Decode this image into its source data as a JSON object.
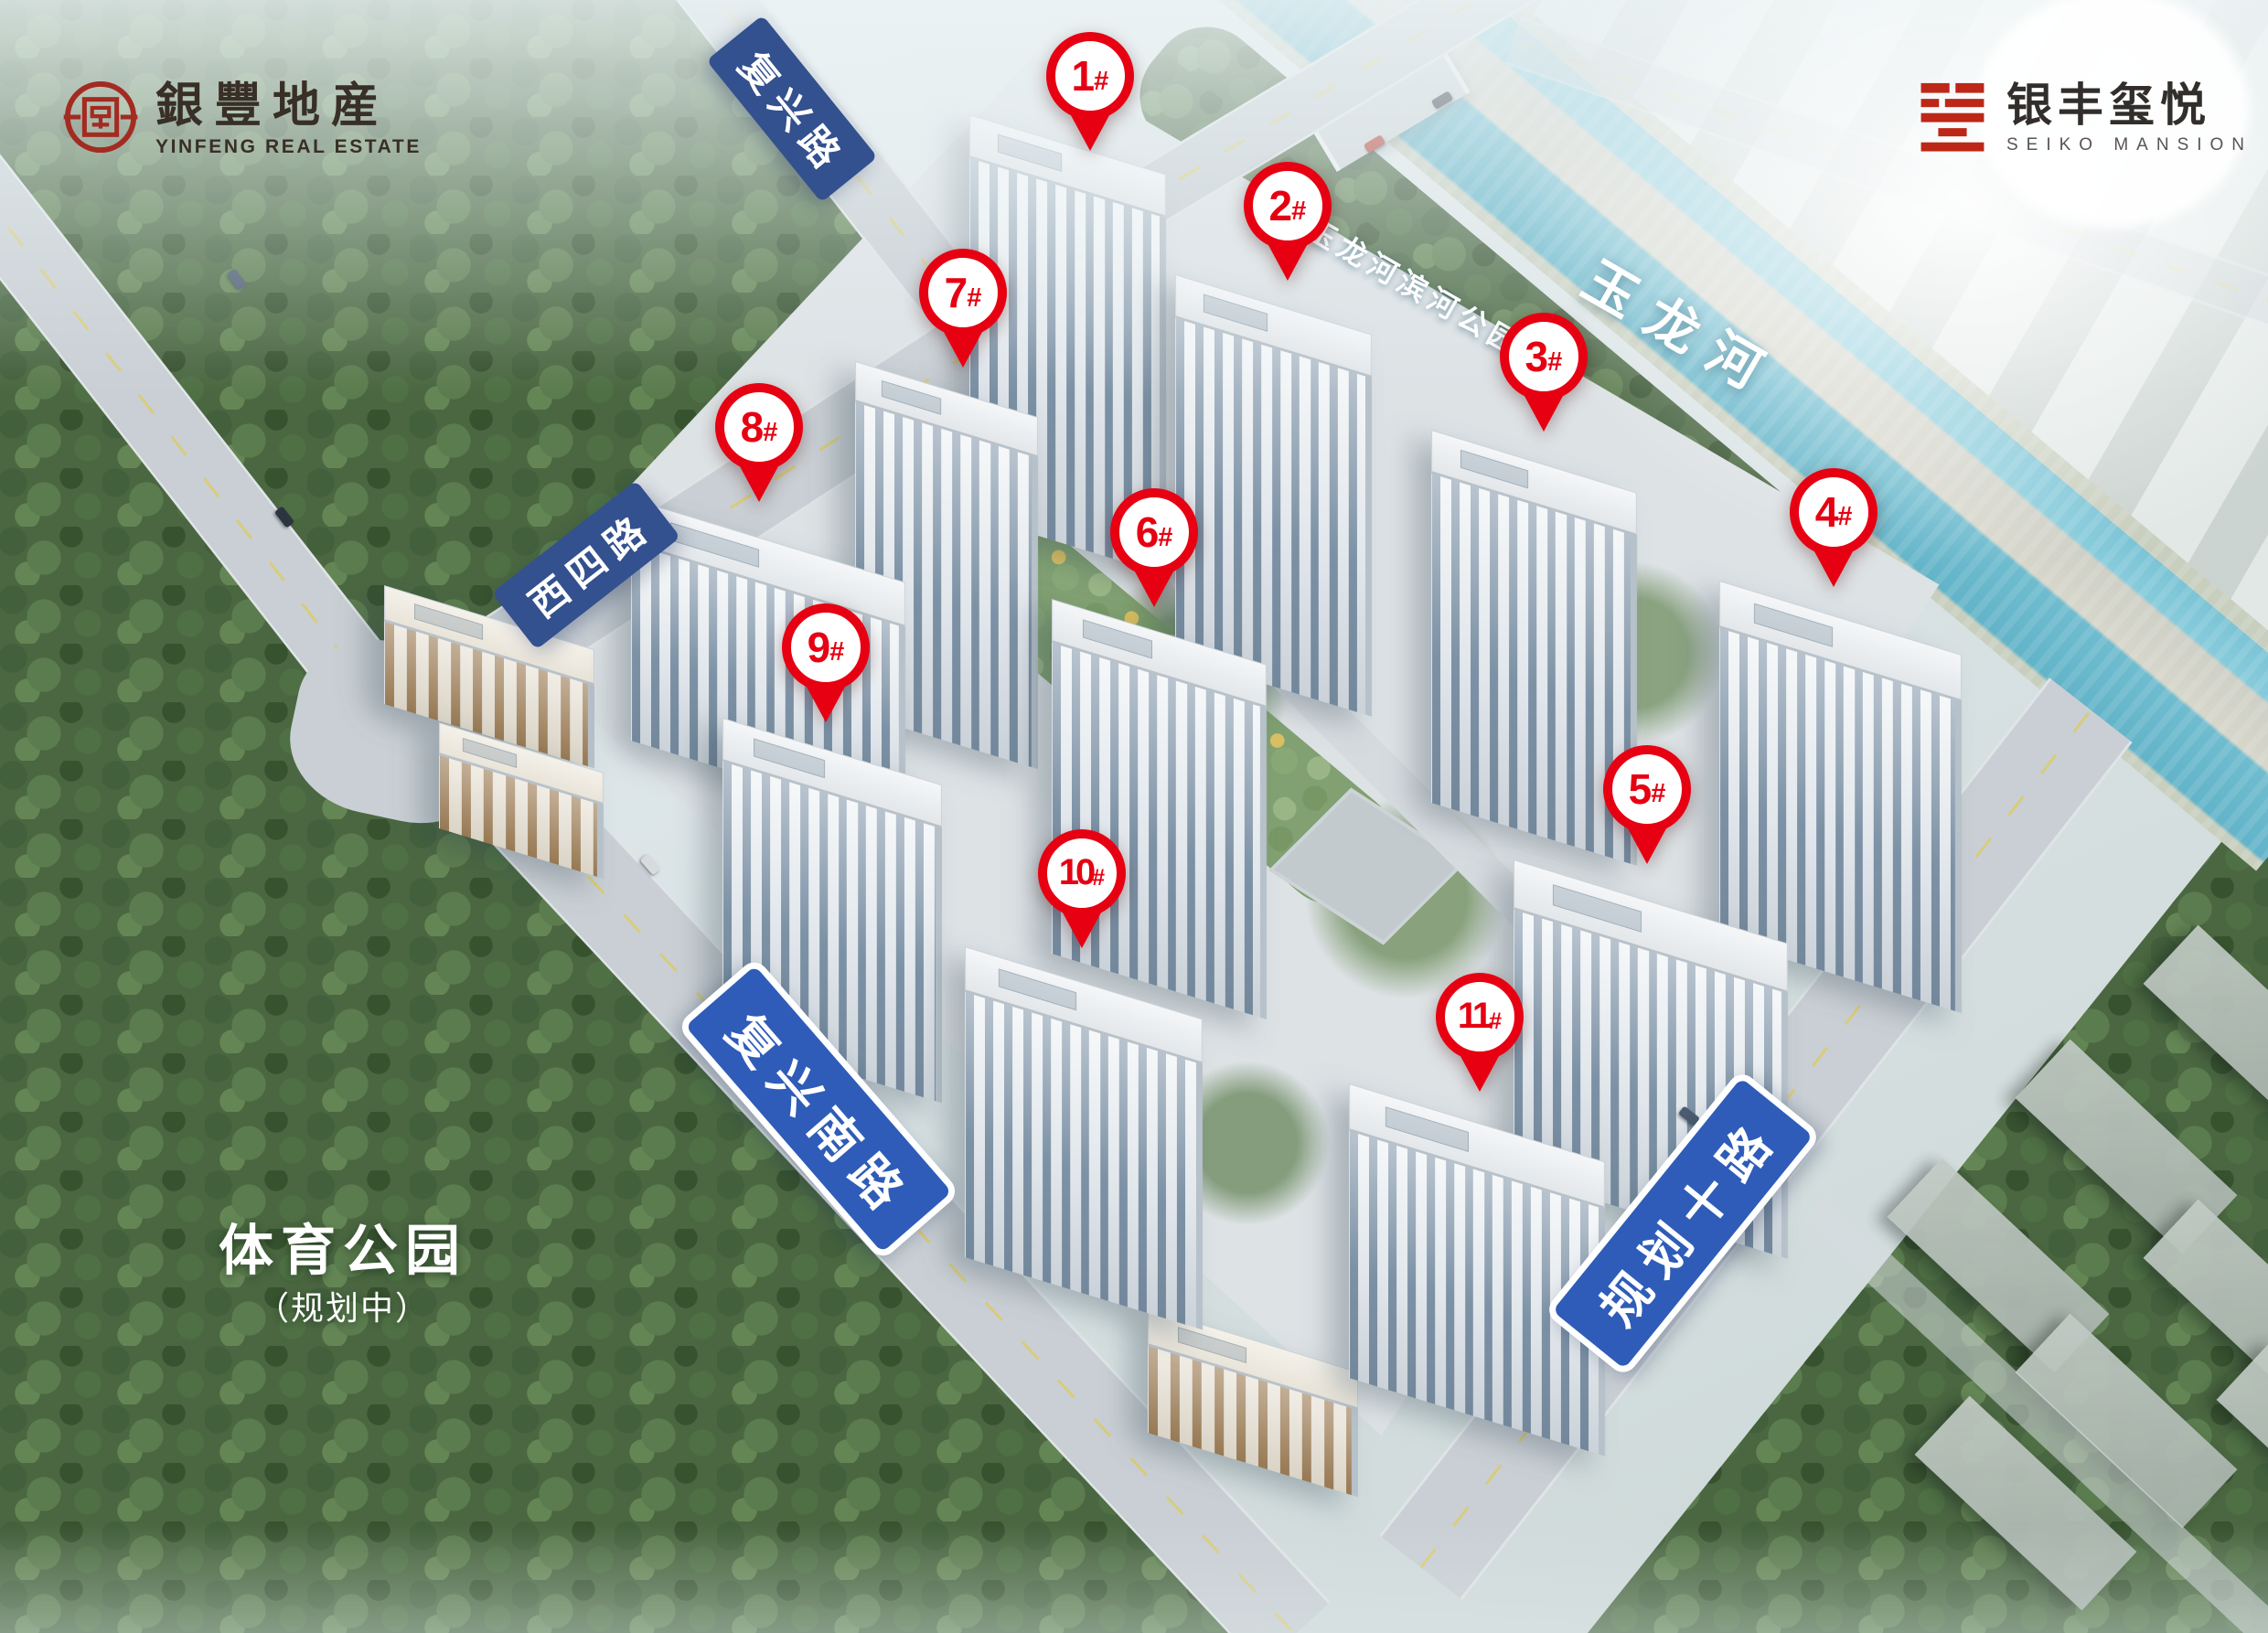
{
  "branding": {
    "developer": {
      "seal_icon": "yinfeng-round-seal",
      "name_cn": "銀豐地産",
      "name_en": "YINFENG REAL ESTATE"
    },
    "project": {
      "seal_icon": "xi-square-seal",
      "name_cn": "银丰玺悦",
      "name_en": "SEIKO MANSION"
    }
  },
  "colors": {
    "marker_red": "#e60012",
    "seal_red": "#a32b21",
    "project_seal_red": "#bd2718",
    "road_banner_dark_blue": "#33508f",
    "road_banner_bright_blue": "#2e5cb8",
    "river_teal": "#6fbccf"
  },
  "building_markers": [
    {
      "label": "1#",
      "x_pct": 48.06,
      "y_pct": 4.65
    },
    {
      "label": "2#",
      "x_pct": 56.77,
      "y_pct": 12.6
    },
    {
      "label": "3#",
      "x_pct": 68.06,
      "y_pct": 21.84
    },
    {
      "label": "4#",
      "x_pct": 80.85,
      "y_pct": 31.35
    },
    {
      "label": "5#",
      "x_pct": 72.62,
      "y_pct": 48.32
    },
    {
      "label": "6#",
      "x_pct": 50.89,
      "y_pct": 32.59
    },
    {
      "label": "7#",
      "x_pct": 42.46,
      "y_pct": 17.92
    },
    {
      "label": "8#",
      "x_pct": 33.47,
      "y_pct": 26.15
    },
    {
      "label": "9#",
      "x_pct": 36.41,
      "y_pct": 39.64
    },
    {
      "label": "10#",
      "x_pct": 47.7,
      "y_pct": 53.47
    },
    {
      "label": "11#",
      "x_pct": 65.24,
      "y_pct": 62.26
    }
  ],
  "road_labels": [
    {
      "text": "复兴路",
      "x_pct": 34.92,
      "y_pct": 6.66,
      "angle_deg": 51,
      "style": "plain"
    },
    {
      "text": "西四路",
      "x_pct": 25.85,
      "y_pct": 34.6,
      "angle_deg": -38,
      "style": "plain"
    },
    {
      "text": "复兴南路",
      "x_pct": 36.09,
      "y_pct": 67.92,
      "angle_deg": 49,
      "style": "bordered"
    },
    {
      "text": "规划十路",
      "x_pct": 74.19,
      "y_pct": 74.92,
      "angle_deg": -51,
      "style": "bordered"
    }
  ],
  "place_labels": [
    {
      "text": "玉龙河",
      "x_pct": 74.19,
      "y_pct": 19.93,
      "angle_deg": 30,
      "style": "river-major"
    },
    {
      "text": "玉龙河滨河公园",
      "x_pct": 62.42,
      "y_pct": 17.52,
      "angle_deg": 30,
      "style": "river-minor"
    },
    {
      "text": "体育公园",
      "x_pct": 15.12,
      "y_pct": 76.32,
      "angle_deg": 0,
      "style": "park-major"
    },
    {
      "text": "（规划中）",
      "x_pct": 15.12,
      "y_pct": 79.96,
      "angle_deg": 0,
      "style": "park-minor"
    }
  ]
}
